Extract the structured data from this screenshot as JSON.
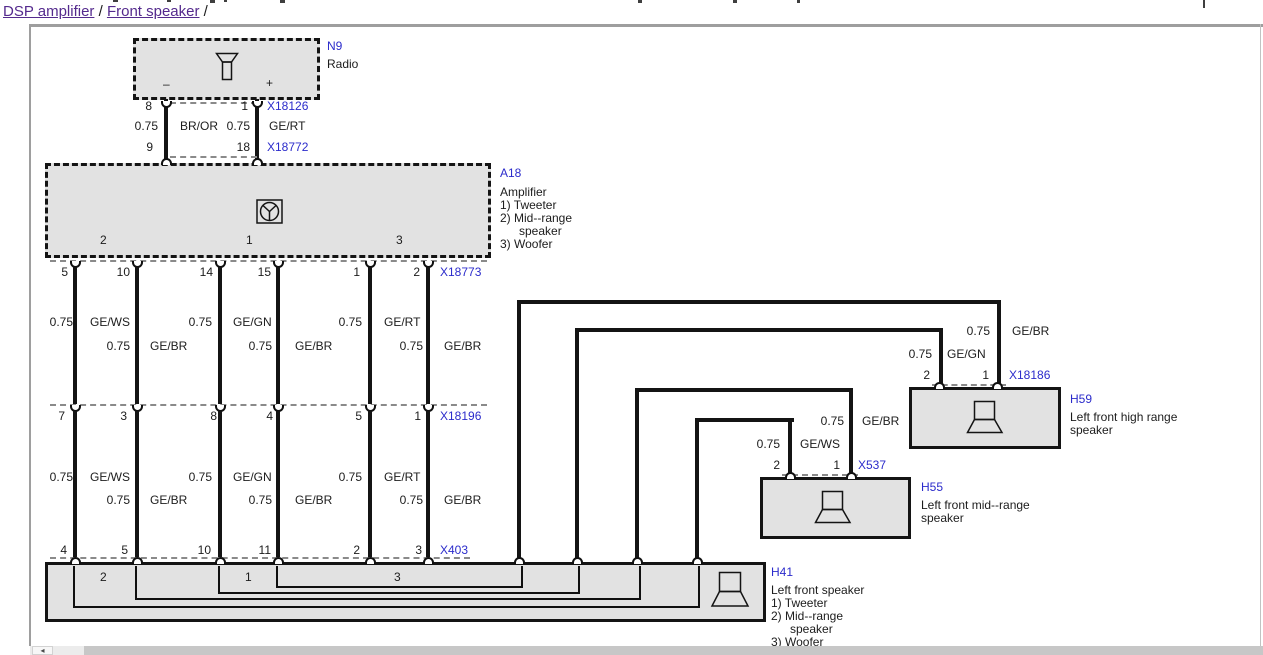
{
  "page": {
    "breadcrumb": {
      "link1": "DSP amplifier",
      "sep": " / ",
      "link2": "Front speaker",
      "tail": " /"
    }
  },
  "n9": {
    "id": "N9",
    "name": "Radio",
    "minus": "–",
    "plus": "+"
  },
  "x18126": {
    "id": "X18126",
    "pins": [
      "8",
      "1"
    ]
  },
  "x18772": {
    "id": "X18772",
    "pins": [
      "9",
      "18"
    ]
  },
  "n9_wires": [
    {
      "size": "0.75",
      "code": "BR/OR"
    },
    {
      "size": "0.75",
      "code": "GE/RT"
    }
  ],
  "a18": {
    "id": "A18",
    "name": "Amplifier",
    "legend": [
      "1) Tweeter",
      "2) Mid--range",
      "speaker",
      "3) Woofer"
    ],
    "zones": [
      "2",
      "1",
      "3"
    ]
  },
  "x18773": {
    "id": "X18773",
    "pins": [
      "5",
      "10",
      "14",
      "15",
      "1",
      "2"
    ]
  },
  "sec1": [
    {
      "size": "0.75",
      "code": "GE/WS"
    },
    {
      "size": "0.75",
      "code": "GE/BR"
    },
    {
      "size": "0.75",
      "code": "GE/GN"
    },
    {
      "size": "0.75",
      "code": "GE/BR"
    },
    {
      "size": "0.75",
      "code": "GE/RT"
    },
    {
      "size": "0.75",
      "code": "GE/BR"
    }
  ],
  "x18196": {
    "id": "X18196",
    "pins": [
      "7",
      "3",
      "8",
      "4",
      "5",
      "1"
    ]
  },
  "sec2": [
    {
      "size": "0.75",
      "code": "GE/WS"
    },
    {
      "size": "0.75",
      "code": "GE/BR"
    },
    {
      "size": "0.75",
      "code": "GE/GN"
    },
    {
      "size": "0.75",
      "code": "GE/BR"
    },
    {
      "size": "0.75",
      "code": "GE/RT"
    },
    {
      "size": "0.75",
      "code": "GE/BR"
    }
  ],
  "x403": {
    "id": "X403",
    "pins": [
      "4",
      "5",
      "10",
      "11",
      "2",
      "3"
    ]
  },
  "h41": {
    "id": "H41",
    "name": "Left front speaker",
    "legend": [
      "1) Tweeter",
      "2) Mid--range",
      "speaker",
      "3) Woofer"
    ],
    "zones": [
      "2",
      "1",
      "3"
    ]
  },
  "right_wires": [
    {
      "size": "0.75",
      "code": "GE/BR"
    },
    {
      "size": "0.75",
      "code": "GE/GN"
    },
    {
      "size": "0.75",
      "code": "GE/BR"
    },
    {
      "size": "0.75",
      "code": "GE/WS"
    }
  ],
  "x18186": {
    "id": "X18186",
    "pins": [
      "2",
      "1"
    ]
  },
  "h59": {
    "id": "H59",
    "name_line1": "Left front high range",
    "name_line2": "speaker"
  },
  "x537": {
    "id": "X537",
    "pins": [
      "2",
      "1"
    ]
  },
  "h55": {
    "id": "H55",
    "name_line1": "Left front mid--range",
    "name_line2": "speaker"
  },
  "colors": {
    "label_blue": "#2b2bcb",
    "link_purple": "#542a8d",
    "box_fill": "#e2e2e2"
  }
}
